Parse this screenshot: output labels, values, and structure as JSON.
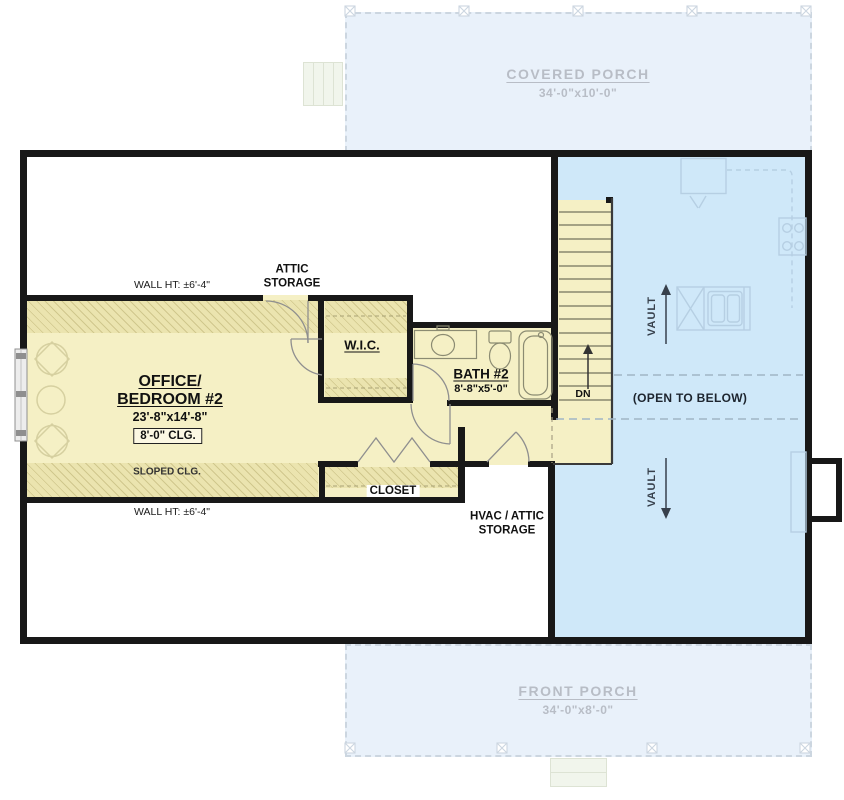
{
  "colors": {
    "wall": "#181818",
    "room_fill": "#f5f0c5",
    "hatch_fill": "#ebe4af",
    "open_to_below_fill": "#cfe8f9",
    "porch_fill": "#e9f1fa",
    "ghost_line": "#b6cfe3",
    "porch_text": "#b8bdc6",
    "vault_text": "#37404c"
  },
  "porches": {
    "covered": {
      "label": "COVERED PORCH",
      "dims": "34'-0\"x10'-0\""
    },
    "front": {
      "label": "FRONT PORCH",
      "dims": "34'-0\"x8'-0\""
    }
  },
  "rooms": {
    "office": {
      "name_line1": "OFFICE/",
      "name_line2": "BEDROOM #2",
      "dims": "23'-8\"x14'-8\"",
      "ceiling": "8'-0\" CLG.",
      "sloped_ceiling": "SLOPED CLG."
    },
    "wic": {
      "name": "W.I.C."
    },
    "bath": {
      "name": "BATH #2",
      "dims": "8'-8\"x5'-0\""
    },
    "closet": {
      "name": "CLOSET"
    },
    "attic_storage": {
      "line1": "ATTIC",
      "line2": "STORAGE"
    },
    "hvac": {
      "line1": "HVAC / ATTIC",
      "line2": "STORAGE"
    }
  },
  "annotations": {
    "wall_height_top": "WALL HT: ±6'-4\"",
    "wall_height_bottom": "WALL HT: ±6'-4\"",
    "open_to_below": "(OPEN TO BELOW)",
    "vault_top": "VAULT",
    "vault_bottom": "VAULT",
    "stairs_down": "DN"
  }
}
